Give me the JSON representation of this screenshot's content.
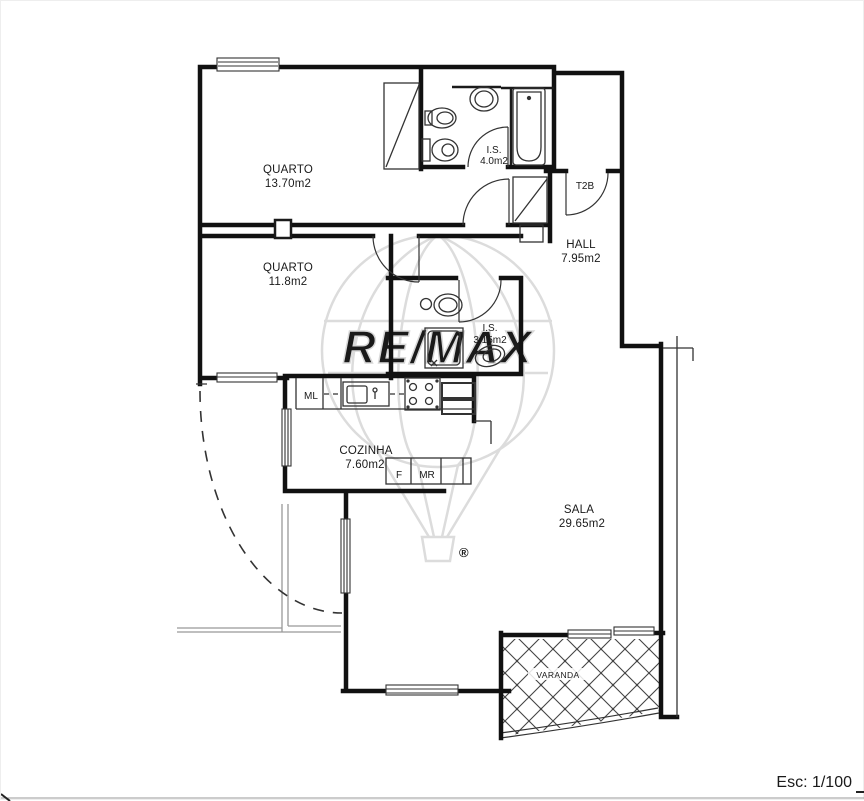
{
  "scale": {
    "label": "Esc: 1/100"
  },
  "unit_type": {
    "label": "T2B"
  },
  "rooms": {
    "quarto1": {
      "name": "QUARTO",
      "area": "13.70m2"
    },
    "quarto2": {
      "name": "QUARTO",
      "area": "11.8m2"
    },
    "is1": {
      "name": "I.S.",
      "area": "4.0m2"
    },
    "is2": {
      "name": "I.S.",
      "area": "3.15m2"
    },
    "hall": {
      "name": "HALL",
      "area": "7.95m2"
    },
    "cozinha": {
      "name": "COZINHA",
      "area": "7.60m2"
    },
    "sala": {
      "name": "SALA",
      "area": "29.65m2"
    },
    "varanda": {
      "name": "VARANDA"
    }
  },
  "appliances": {
    "washing_machine": "ML",
    "fridge": "F",
    "microwave": "MR"
  },
  "watermark": {
    "brand": "RE/MAX",
    "registered": "®"
  },
  "colors": {
    "wall": "#111111",
    "detail": "#333333",
    "light": "#999999",
    "watermark": "#dcdcdc",
    "hatch": "#444444"
  }
}
